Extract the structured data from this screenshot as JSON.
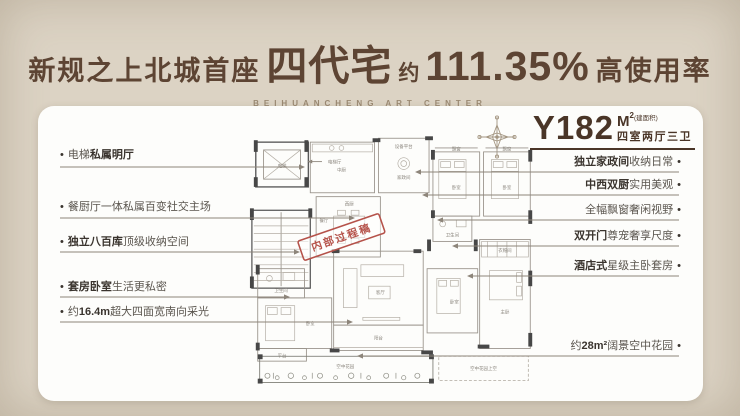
{
  "header": {
    "title_prefix": "新规之上北城首座",
    "title_highlight": "四代宅",
    "approx": "约",
    "percentage": "111.35%",
    "title_suffix": "高使用率",
    "subtitle": "BEIHUANCHENG ART CENTER"
  },
  "unit": {
    "model": "Y182",
    "unit_symbol": "M",
    "unit_sup": "2",
    "note": "(建面积)",
    "layout": "四室两厅三卫"
  },
  "stamp": "内部过程稿",
  "colors": {
    "brand_brown": "#5d4433",
    "background": "#dcd3c4",
    "card": "#fdfdfb",
    "stamp_red": "#b5524a",
    "leader_line": "#8d857a"
  },
  "left_annotations": [
    {
      "pre": "电梯",
      "bold": "私属明厅",
      "post": ""
    },
    {
      "pre": "餐厨厅一体私属百变社交主场",
      "bold": "",
      "post": ""
    },
    {
      "pre": "",
      "bold": "独立八百库",
      "post": "顶级收纳空间"
    },
    {
      "pre": "",
      "bold": "套房卧室",
      "post": "生活更私密"
    },
    {
      "pre": "约",
      "bold": "16.4m",
      "post": "超大四面宽南向采光"
    }
  ],
  "right_annotations": [
    {
      "pre": "",
      "bold": "独立家政间",
      "post": "收纳日常"
    },
    {
      "pre": "",
      "bold": "中西双厨",
      "post": "实用美观"
    },
    {
      "pre": "全幅飘窗奢闲视野",
      "bold": "",
      "post": ""
    },
    {
      "pre": "",
      "bold": "双开门",
      "post": "尊宠奢享尺度"
    },
    {
      "pre": "",
      "bold": "酒店式",
      "post": "星级主卧套房"
    },
    {
      "pre": "约",
      "bold": "28m²",
      "post": "阔景空中花园"
    }
  ],
  "rooms": {
    "elevator": "电梯",
    "elevator_hall": "电梯厅",
    "equipment": "设备平台",
    "laundry": "家政间",
    "kitchen_cn": "中厨",
    "kitchen_w": "西厨",
    "dining": "餐厅",
    "bath": "卫生间",
    "bedroom": "卧室",
    "bay": "飘窗",
    "living": "客厅",
    "balcony": "阳台",
    "master": "主卧",
    "cloak": "衣帽间",
    "terrace": "平台",
    "garden": "空中花园",
    "garden_above": "空中花园上空"
  }
}
